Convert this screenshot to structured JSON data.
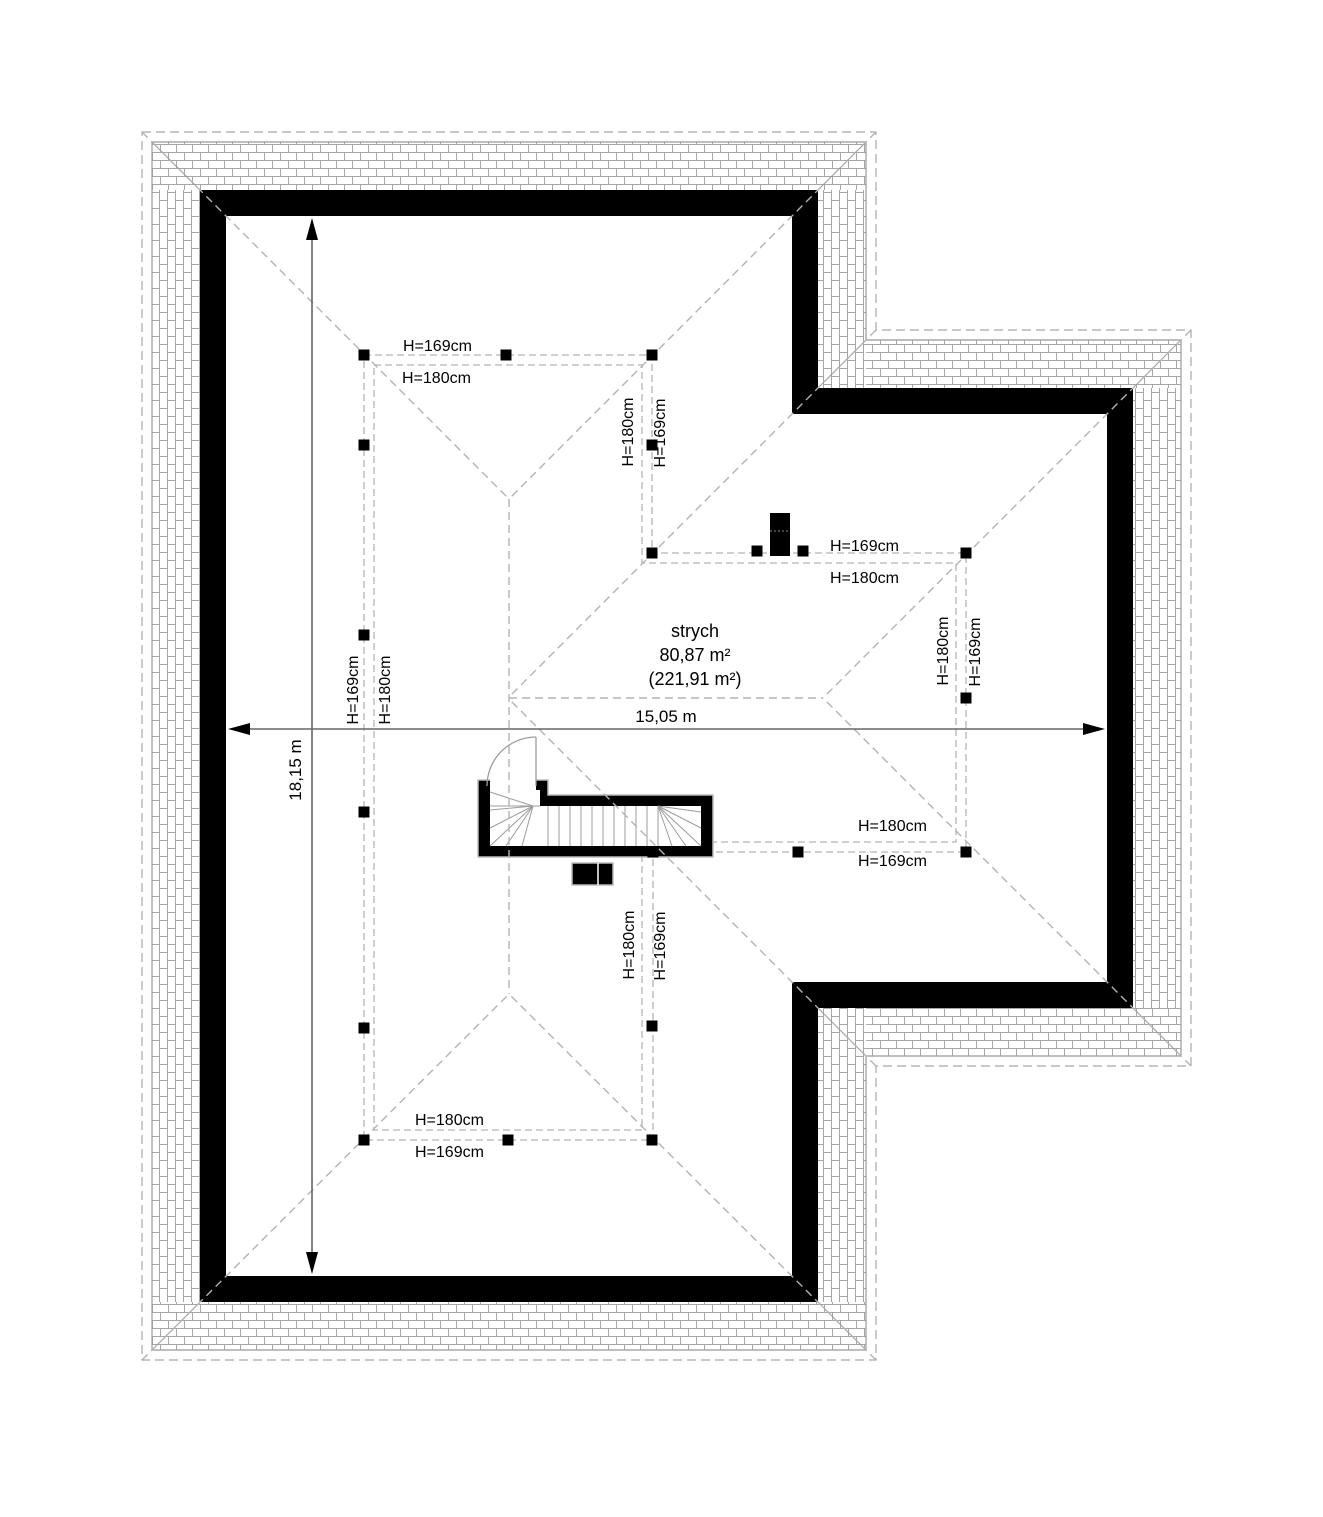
{
  "document": {
    "type": "attic-floor-plan"
  },
  "room": {
    "name": "strych",
    "area": "80,87 m²",
    "total_area": "(221,91 m²)"
  },
  "dimensions": {
    "width": "15,05 m",
    "depth": "18,15 m"
  },
  "labels": {
    "h169": "H=169cm",
    "h180": "H=180cm"
  }
}
